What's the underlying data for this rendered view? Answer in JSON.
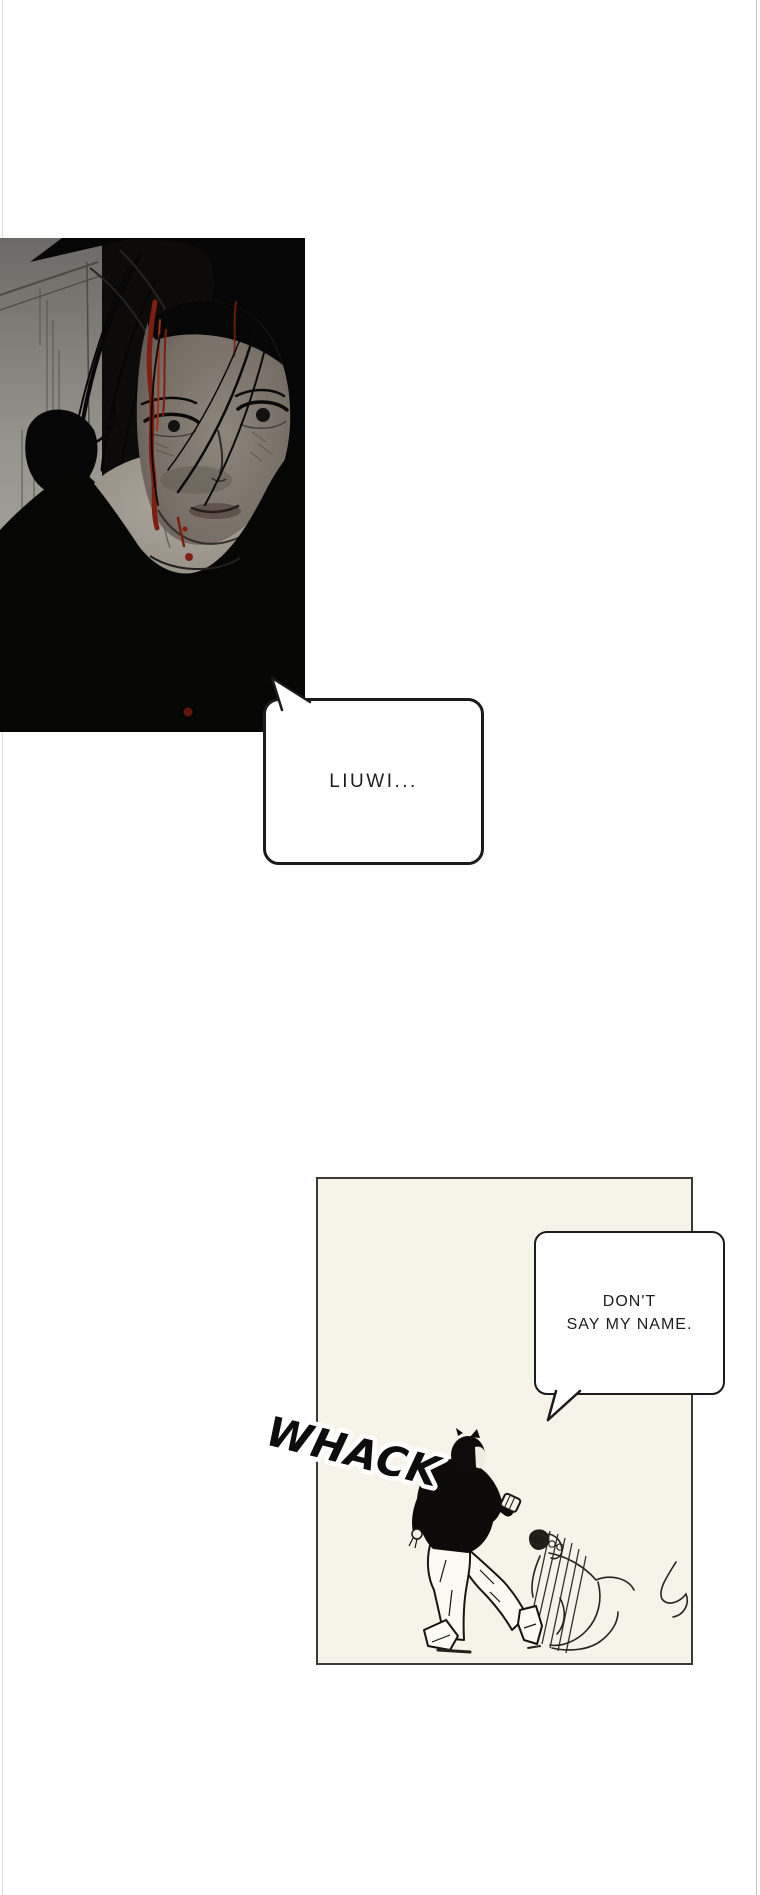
{
  "page": {
    "background": "#ffffff"
  },
  "panel_dark": {
    "name": "panel-portrait-dark",
    "scene": "Close-up of a dark-haired person with blood running down their face, head lowered",
    "bg": "#0b0a09",
    "wall_gray": "#98978f",
    "skin_gray": "#968f85",
    "blood_red": "#7c1f10"
  },
  "panel_kick": {
    "name": "panel-kick-scene",
    "scene": "A standing figure in a black shirt kicks a crouching sketched figure",
    "bg": "#f6f3e8",
    "border": "#3a3a36"
  },
  "bubble_liuwi": {
    "text": "LIUWI..."
  },
  "bubble_dont": {
    "line1": "DON'T",
    "line2": "SAY MY NAME."
  },
  "sfx": {
    "whack": "WHACK"
  }
}
